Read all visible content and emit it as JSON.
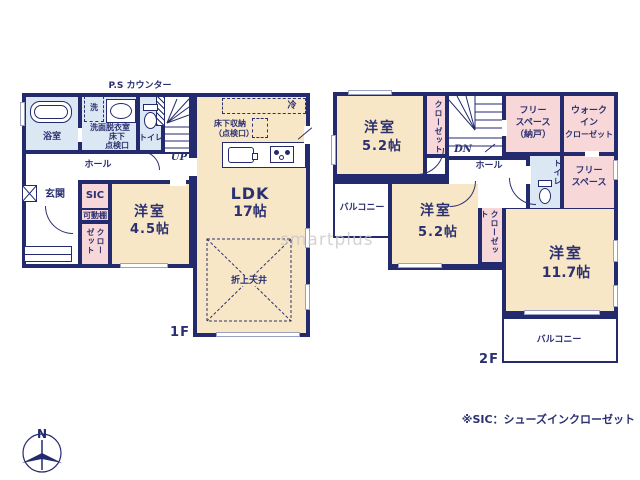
{
  "watermark": "smartplus",
  "footnote": "※SIC：シューズインクローゼット",
  "compass": {
    "north": "N"
  },
  "colors": {
    "wall": "#232a6d",
    "room_cream": "#f8e7c6",
    "room_pink": "#f8d7d8",
    "room_blue": "#dbe8f4",
    "text": "#2b3070",
    "watermark": "#c9c9c9"
  },
  "f1": {
    "label": "1F",
    "ps_counter": "P.S カウンター",
    "bath": "浴室",
    "washer": "洗",
    "washroom": "洗面脱衣室",
    "hatch_l1": "床下",
    "hatch_l2": "点検口",
    "toilet": "トイレ",
    "up": "UP",
    "hall": "ホール",
    "entrance": "玄関",
    "sic": "SIC",
    "shelf": "可動棚",
    "closet": "クローゼット",
    "bedroom_name": "洋室",
    "bedroom_size": "4.5帖",
    "ldk_name": "LDK",
    "ldk_size": "17帖",
    "storage_l1": "床下収納",
    "storage_l2": "（点検口）",
    "fridge": "冷",
    "ceiling": "折上天井"
  },
  "f2": {
    "label": "2F",
    "b1_name": "洋室",
    "b1_size": "5.2帖",
    "closet1": "クローゼット",
    "dn": "DN",
    "hall": "ホール",
    "free1_l1": "フリー",
    "free1_l2": "スペース",
    "free1_l3": "（納戸）",
    "wic_l1": "ウォーク",
    "wic_l2": "イン",
    "wic_l3": "クローゼット",
    "toilet": "トイレ",
    "free2_l1": "フリー",
    "free2_l2": "スペース",
    "balcony_left": "バルコニー",
    "b2_name": "洋室",
    "b2_size": "5.2帖",
    "closet2": "クローゼット",
    "b3_name": "洋室",
    "b3_size": "11.7帖",
    "balcony_bottom": "バルコニー"
  }
}
